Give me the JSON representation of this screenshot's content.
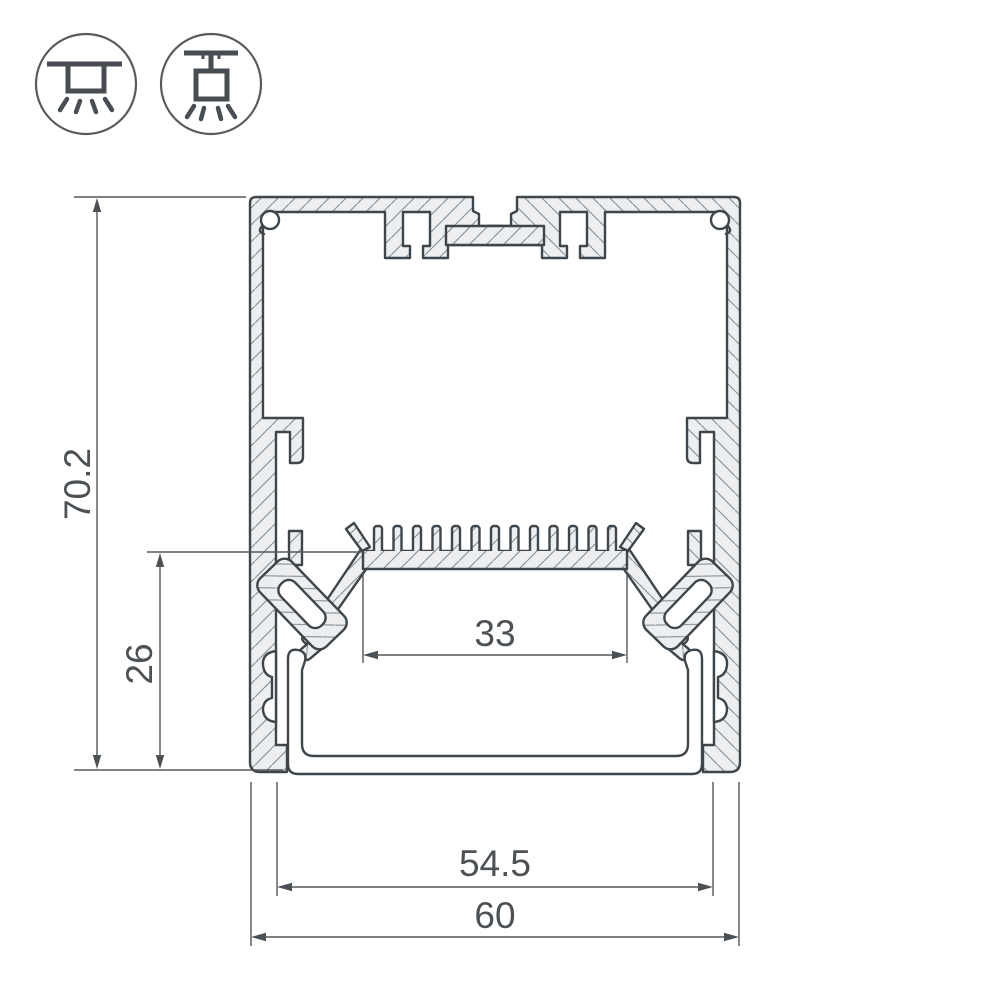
{
  "page": {
    "background": "#ffffff"
  },
  "icons": {
    "surface_mount": "surface-mounted-luminaire",
    "pendant": "suspended-luminaire"
  },
  "dimensions": {
    "overall_height": "70.2",
    "inner_depth": "26",
    "led_shelf_width": "33",
    "inner_width": "54.5",
    "overall_width": "60"
  },
  "colors": {
    "outline": "#3f464b",
    "dimension_lines": "#54585c",
    "dimension_text": "#4c5156",
    "aluminium_fill": "#eceeef",
    "hatch_lines": "#878d91",
    "icon_stroke": "#474d52"
  }
}
